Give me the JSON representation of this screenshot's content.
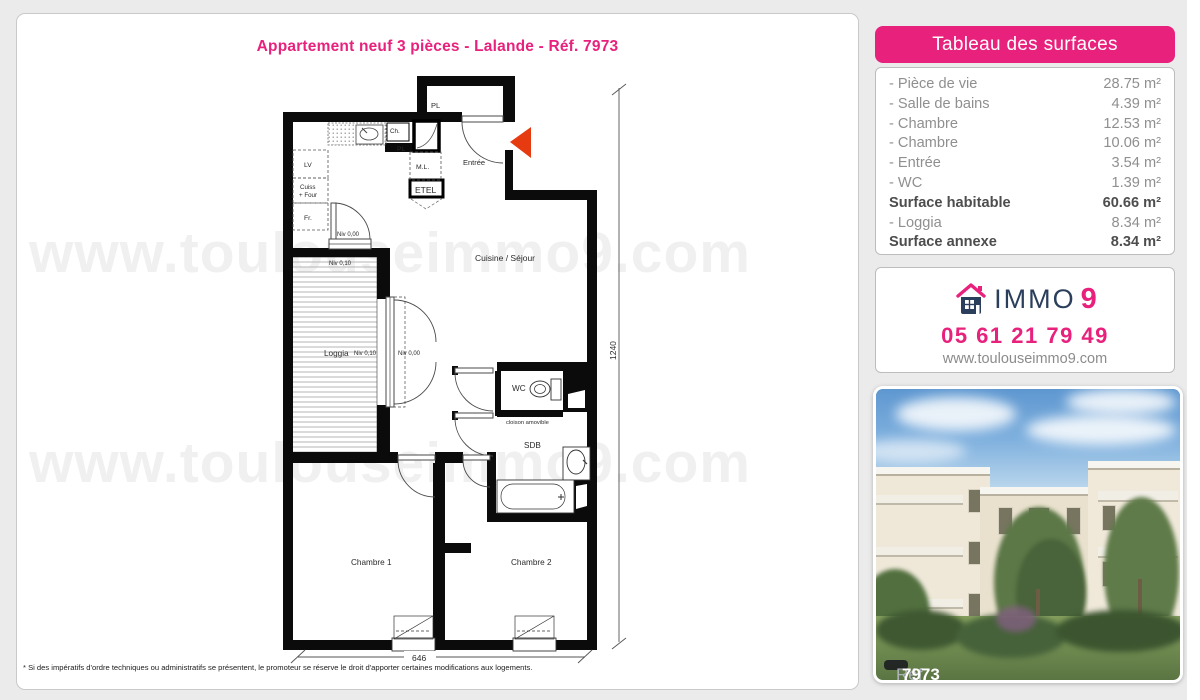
{
  "page": {
    "title": "Appartement neuf 3 pièces - Lalande - Réf. 7973",
    "watermark": "www.toulouseimmo9.com",
    "footnote": "* Si des impératifs d'ordre techniques ou administratifs se présentent, le promoteur se réserve le droit d'apporter certaines modifications aux logements."
  },
  "surfaces": {
    "header": "Tableau des surfaces",
    "rows": [
      {
        "label": "- Pièce de vie",
        "value": "28.75 m²"
      },
      {
        "label": "- Salle de bains",
        "value": "4.39 m²"
      },
      {
        "label": "- Chambre",
        "value": "12.53 m²"
      },
      {
        "label": "- Chambre",
        "value": "10.06 m²"
      },
      {
        "label": "- Entrée",
        "value": "3.54 m²"
      },
      {
        "label": "- WC",
        "value": "1.39 m²"
      },
      {
        "label": "Surface habitable",
        "value": "60.66 m²"
      },
      {
        "label": "- Loggia",
        "value": "8.34 m²"
      },
      {
        "label": "Surface annexe",
        "value": "8.34 m²"
      }
    ]
  },
  "contact": {
    "brand_text": "IMMO",
    "brand_digit": "9",
    "phone": "05 61 21 79 49",
    "website": "www.toulouseimmo9.com"
  },
  "photo": {
    "ref_label": "Réf.",
    "ref_number": "7973"
  },
  "plan": {
    "rooms": {
      "entree": "Entrée",
      "cuisine_sejour": "Cuisine / Séjour",
      "loggia": "Loggia",
      "wc": "WC",
      "sdb": "SDB",
      "chambre1": "Chambre 1",
      "chambre2": "Chambre 2"
    },
    "fixtures": {
      "pl_closet": "PL",
      "ch": "Ch.",
      "pl": "PL",
      "ml": "M.L.",
      "etel": "ETEL",
      "lv": "LV",
      "cuiss_line1": "Cuiss",
      "cuiss_line2": "+ Four",
      "fr": "Fr.",
      "cloison": "cloison amovible"
    },
    "levels": {
      "niv000": "Niv 0,00",
      "niv010": "Niv 0,10"
    },
    "dimensions": {
      "height": "1240",
      "width": "646"
    }
  },
  "colors": {
    "accent_pink": "#e8217c",
    "navy": "#2b3f5c",
    "arrow_red": "#e63b11"
  }
}
